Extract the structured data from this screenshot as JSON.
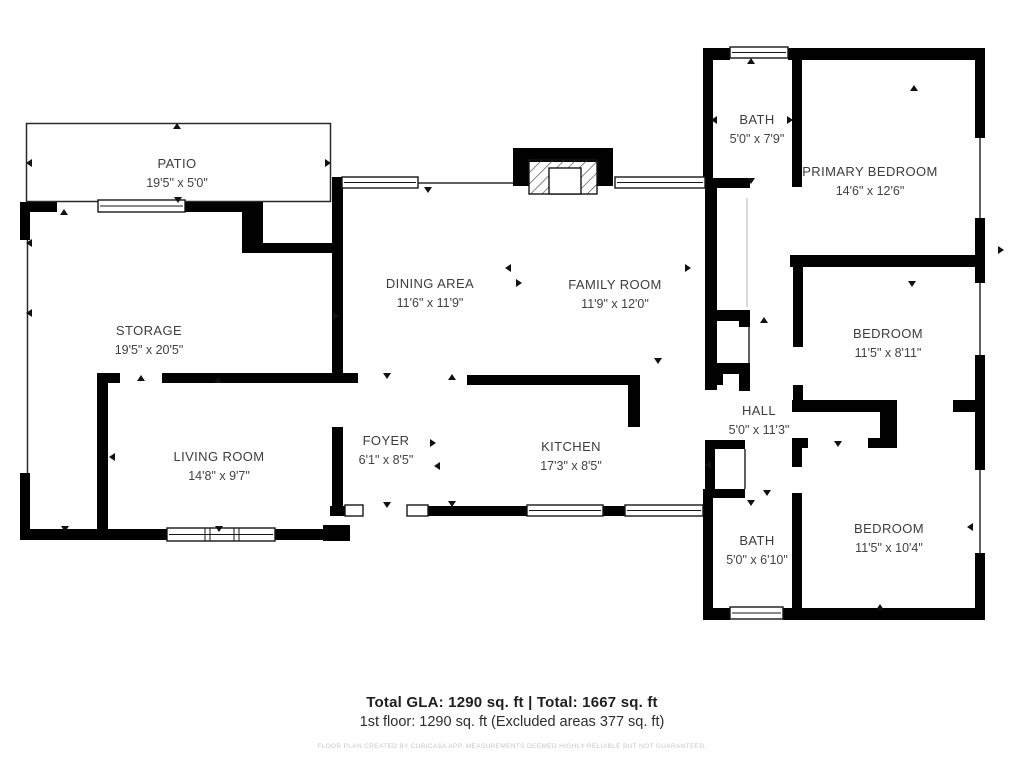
{
  "plan": {
    "rooms": [
      {
        "id": "patio",
        "name": "PATIO",
        "dims": "19'5\" x 5'0\""
      },
      {
        "id": "storage",
        "name": "STORAGE",
        "dims": "19'5\" x 20'5\""
      },
      {
        "id": "living-room",
        "name": "LIVING ROOM",
        "dims": "14'8\" x 9'7\""
      },
      {
        "id": "dining-area",
        "name": "DINING AREA",
        "dims": "11'6\" x 11'9\""
      },
      {
        "id": "family-room",
        "name": "FAMILY ROOM",
        "dims": "11'9\" x 12'0\""
      },
      {
        "id": "foyer",
        "name": "FOYER",
        "dims": "6'1\" x 8'5\""
      },
      {
        "id": "kitchen",
        "name": "KITCHEN",
        "dims": "17'3\" x 8'5\""
      },
      {
        "id": "bath-upper",
        "name": "BATH",
        "dims": "5'0\" x 7'9\""
      },
      {
        "id": "primary-bedroom",
        "name": "PRIMARY BEDROOM",
        "dims": "14'6\" x 12'6\""
      },
      {
        "id": "bedroom-mid",
        "name": "BEDROOM",
        "dims": "11'5\" x 8'11\""
      },
      {
        "id": "hall",
        "name": "HALL",
        "dims": "5'0\" x 11'3\""
      },
      {
        "id": "bath-lower",
        "name": "BATH",
        "dims": "5'0\" x 6'10\""
      },
      {
        "id": "bedroom-lower",
        "name": "BEDROOM",
        "dims": "11'5\" x 10'4\""
      }
    ],
    "footer": {
      "line1": "Total GLA: 1290 sq. ft | Total: 1667 sq. ft",
      "line2": "1st floor: 1290 sq. ft (Excluded areas 377 sq. ft)",
      "disclaimer": "FLOOR PLAN CREATED BY CUBICASA APP. MEASUREMENTS DEEMED HIGHLY RELIABLE BUT NOT GUARANTEED."
    },
    "colors": {
      "wall": "#010101",
      "label_text": "#3d3d3d",
      "footer_text": "#1f1f1f",
      "disclaimer_text": "#c7c7c7"
    },
    "symbols": {
      "fireplace": "hatched-box-top-center",
      "windows": "double-line-openings",
      "doors": "wall-gaps-with-arrow-markers"
    }
  }
}
